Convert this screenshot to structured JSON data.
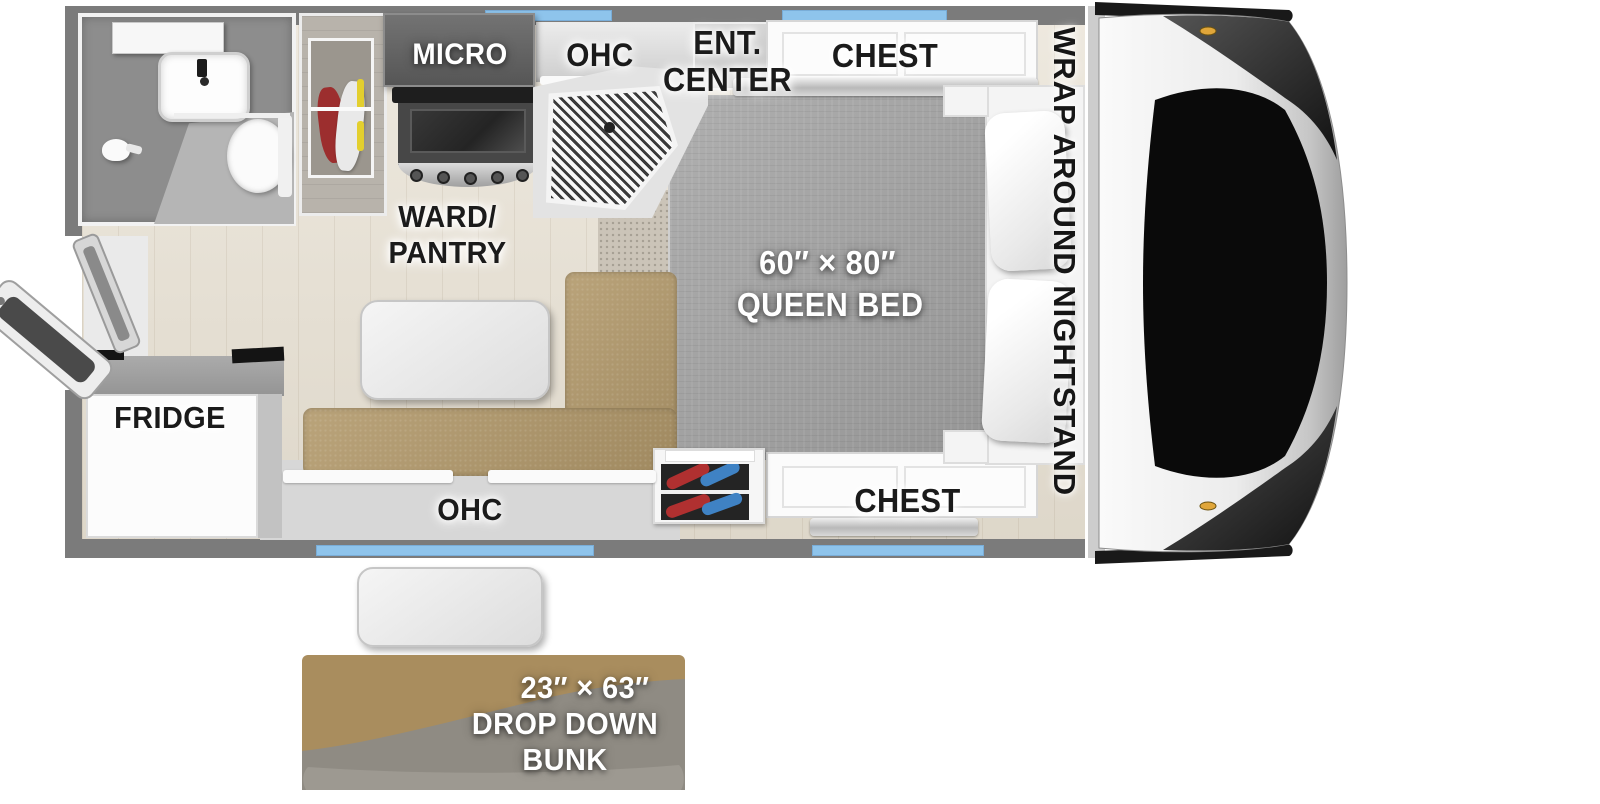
{
  "colors": {
    "wall": "#7b7b7b",
    "window_glass": "#8ec4ec",
    "floor_wood": "#e7e0d2",
    "bed_fabric": "#a6a6a6",
    "sofa_tan": "#b2996b",
    "bunk_tan": "#a98d5e",
    "bunk_gray": "#8f8b83",
    "clothes_red": "#9c2e2e",
    "item_blue": "#3f82c4",
    "label_dark": "#1b1b1b",
    "label_light": "#ffffff"
  },
  "labels": {
    "micro": "MICRO",
    "ohc_kitchen": "OHC",
    "ent_center": {
      "line1": "ENT.",
      "line2": "CENTER"
    },
    "chest_top": "CHEST",
    "chest_bottom": "CHEST",
    "wrap_around_nightstand": "WRAP AROUND NIGHTSTAND",
    "queen_bed": {
      "line1": "60″ × 80″",
      "line2": "QUEEN BED"
    },
    "ward_pantry": {
      "line1": "WARD/",
      "line2": "PANTRY"
    },
    "fridge": "FRIDGE",
    "ohc_dinette": "OHC",
    "drop_down_bunk": {
      "line1": "23″ × 63″",
      "line2": "DROP DOWN",
      "line3": "BUNK"
    }
  },
  "fixtures": [
    "entry-door",
    "screen-door",
    "shower-head",
    "bathroom-sink",
    "bathroom-faucet",
    "medicine-cabinet",
    "toilet",
    "hanging-clothes",
    "microwave",
    "range-oven",
    "range-hood",
    "kitchen-sink-counter",
    "overhead-cabinet",
    "entertainment-center",
    "chest-of-drawers",
    "queen-bed",
    "pillow",
    "wrap-around-nightstand",
    "storage-cubby",
    "sofa-dinette",
    "dinette-table",
    "area-rug",
    "refrigerator",
    "window",
    "front-cap",
    "cab-window",
    "clearance-light",
    "drop-down-bunk",
    "bunk-table"
  ]
}
